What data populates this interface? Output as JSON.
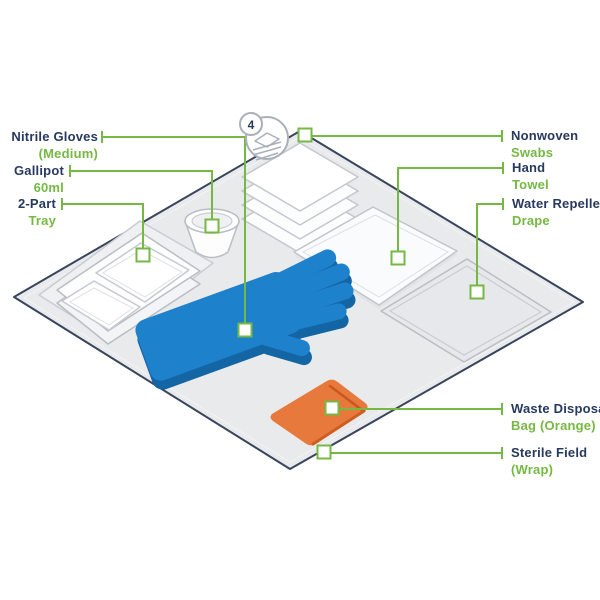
{
  "diagram_title": "Sterile dressing pack contents",
  "badge": {
    "count": "4"
  },
  "colors": {
    "accent_green": "#75b843",
    "label_navy": "#27395f",
    "glove_blue": "#1e81cc",
    "glove_blue_dark": "#1465a3",
    "bag_orange": "#e8793d",
    "bag_orange_dark": "#c9571d",
    "field_grey": "#e9eaec",
    "field_outline": "#39455c",
    "item_stroke": "#b9bec4"
  },
  "labels": [
    {
      "id": "nitrile-gloves",
      "line1": "Nitrile Gloves",
      "line2": "(Medium)"
    },
    {
      "id": "gallipot",
      "line1": "Gallipot",
      "line2": "60ml"
    },
    {
      "id": "two-part-tray",
      "line1": "2-Part",
      "line2": "Tray"
    },
    {
      "id": "nonwoven-swabs",
      "line1": "Nonwoven",
      "line2": "Swabs"
    },
    {
      "id": "hand-towel",
      "line1": "Hand",
      "line2": "Towel"
    },
    {
      "id": "water-repellent-drape",
      "line1": "Water Repellent",
      "line2": "Drape"
    },
    {
      "id": "waste-disposal-bag",
      "line1": "Waste Disposal",
      "line2": "Bag (Orange)"
    },
    {
      "id": "sterile-field",
      "line1": "Sterile Field",
      "line2": "(Wrap)"
    }
  ]
}
